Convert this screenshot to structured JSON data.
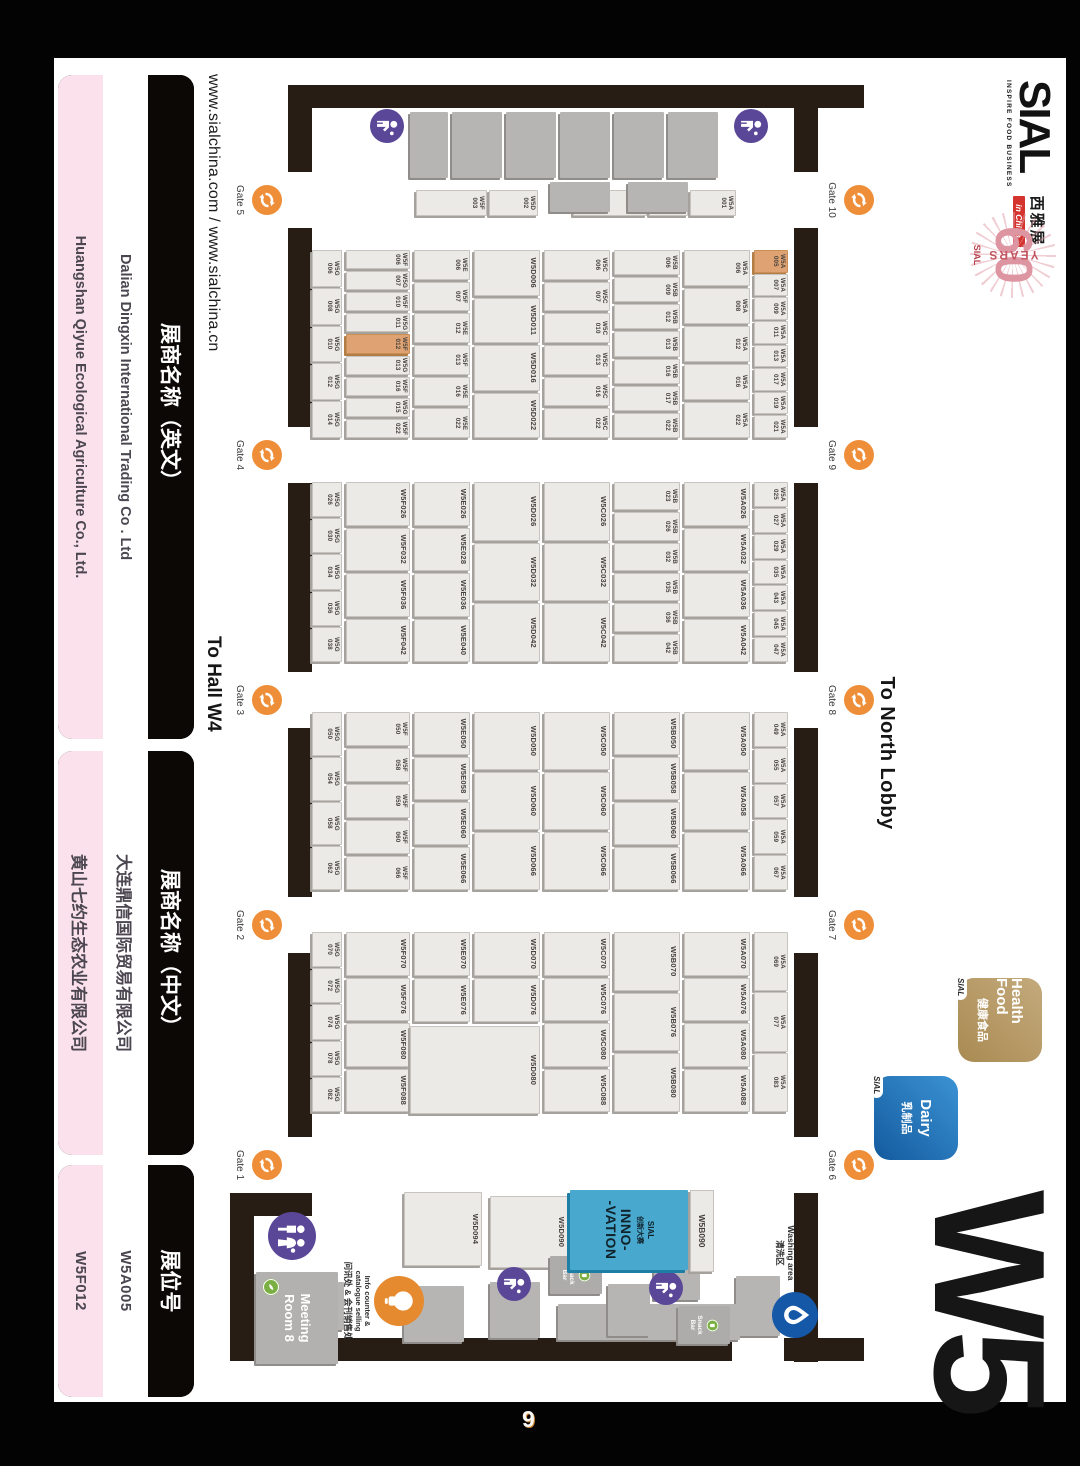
{
  "page": {
    "number": "9"
  },
  "header": {
    "url": "www.sialchina.com / www.sialchina.cn",
    "to_hall": "To Hall W4",
    "to_north_lobby": "To North Lobby",
    "hall_code": "W5"
  },
  "logo": {
    "name": "SIAL",
    "tagline": "INSPIRE FOOD BUSINESS",
    "cn": "西雅展",
    "in_china": "in China",
    "anniversary_60": "60",
    "anniversary_years": "YEARS",
    "anniversary_sial": "SIAL"
  },
  "badges": [
    {
      "id": "health-food",
      "line1": "Health Food",
      "cn": "健康食品",
      "brand": "SIAL",
      "color": "#b2945f"
    },
    {
      "id": "dairy",
      "line1": "Dairy",
      "cn": "乳制品",
      "brand": "SIAL",
      "color": "#1e6fb5"
    }
  ],
  "gates": {
    "top": [
      "Gate 10",
      "Gate 9",
      "Gate 8",
      "Gate 7",
      "Gate 6"
    ],
    "bottom": [
      "Gate 5",
      "Gate 4",
      "Gate 3",
      "Gate 2",
      "Gate 1"
    ]
  },
  "facilities": {
    "washing_line1": "Washing area",
    "washing_line2": "清洗区",
    "info_line1": "Info counter &",
    "info_line2": "catalogue selling",
    "info_line3": "问讯处 & 会刊销售处",
    "meeting_room": "Meeting Room 8",
    "snack_bar": "Snack Bar",
    "innovation": {
      "booth": "W5B090",
      "brand": "SIAL",
      "cn": "创新大赛",
      "line1": "INNO-",
      "line2": "-VATION"
    }
  },
  "legend": {
    "boxes": [
      {
        "title": "展商名称（英文）",
        "rows": [
          "Dalian Dingxin International Trading Co . Ltd",
          "Huangshan Qiyue Ecological Agriculture Co., Ltd."
        ]
      },
      {
        "title": "展商名称（中文）",
        "rows": [
          "大连鼎信国际贸易有限公司",
          "黄山七约生态农业有限公司"
        ]
      },
      {
        "title": "展位号",
        "rows": [
          "W5A005",
          "W5F012"
        ]
      }
    ]
  },
  "highlighted_booths": [
    "W5A005",
    "W5F012"
  ],
  "plan": {
    "left_column": [
      {
        "t": "W5A001",
        "wt": 1.2
      },
      {
        "t": "W5B001",
        "wt": 1.0
      },
      {
        "t": "W5C001",
        "wt": 2.0
      },
      {
        "sp": 0.8
      },
      {
        "t": "W5D002",
        "wt": 1.3
      },
      {
        "t": "W5F003",
        "wt": 1.9
      }
    ],
    "bands": [
      {
        "id": "a-strip",
        "segments": [
          [
            "W5A005",
            "W5A007",
            "W5A009",
            "W5A011",
            "W5A013",
            "W5A017",
            "W5A019",
            "W5A021"
          ],
          [
            "W5A025",
            "W5A027",
            "W5A029",
            "W5A035",
            "W5A043",
            "W5A045",
            "W5A047"
          ],
          [
            "W5A049",
            "W5A055",
            "W5A057",
            "W5A059",
            "W5A067"
          ],
          [
            "W5A069",
            "W5A077",
            "W5A083"
          ]
        ]
      },
      {
        "id": "row-a",
        "segments": [
          [
            "W5A006",
            "W5A008",
            "W5A012",
            "W5A016",
            "W5A022"
          ],
          [
            "W5A026",
            "W5A032",
            "W5A036",
            "W5A042"
          ],
          [
            "W5A050",
            "W5A058",
            "W5A066"
          ],
          [
            "W5A070",
            "W5A076",
            "W5A080",
            "W5A088"
          ]
        ]
      },
      {
        "id": "row-b",
        "segments": [
          [
            "W5B006",
            "W5B009",
            "W5B012",
            "W5B013",
            "W5B016",
            "W5B017",
            "W5B022"
          ],
          [
            "W5B023",
            "W5B026",
            "W5B032",
            "W5B035",
            "W5B036",
            "W5B042"
          ],
          [
            "W5B050",
            "W5B058",
            "W5B060",
            "W5B066"
          ],
          [
            "W5B070",
            "W5B076",
            "W5B080"
          ]
        ]
      },
      {
        "id": "row-c",
        "segments": [
          [
            "W5C006",
            "W5C007",
            "W5C010",
            "W5C013",
            "W5C016",
            "W5C022"
          ],
          [
            "W5C026",
            "W5C032",
            "W5C042"
          ],
          [
            "W5C050",
            "W5C060",
            "W5C066"
          ],
          [
            "W5C070",
            "W5C076",
            "W5C080",
            "W5C088"
          ]
        ]
      },
      {
        "id": "row-d",
        "segments": [
          [
            "W5D006",
            "W5D011",
            "W5D016",
            "W5D022"
          ],
          [
            "W5D026",
            "W5D032",
            "W5D042"
          ],
          [
            "W5D050",
            "W5D060",
            "W5D066"
          ],
          [
            "W5D070",
            "W5D076"
          ]
        ]
      },
      {
        "id": "row-e",
        "segments": [
          [
            "W5E006",
            "W5F007",
            "W5E012",
            "W5F013",
            "W5E016",
            "W5E022"
          ],
          [
            "W5E026",
            "W5E028",
            "W5E036",
            "W5E040"
          ],
          [
            "W5E050",
            "W5E058",
            "W5E060",
            "W5E066"
          ],
          [
            "W5E070",
            "W5E076"
          ]
        ]
      },
      {
        "id": "row-f",
        "segments": [
          [
            "W5F006",
            "W5G007",
            "W5F010",
            "W5G011",
            "W5F012",
            "W5G013",
            "W5F016",
            "W5G015",
            "W5F022"
          ],
          [
            "W5F026",
            "W5F032",
            "W5F036",
            "W5F042"
          ],
          [
            "W5F050",
            "W5F058",
            "W5F059",
            "W5F060",
            "W5F066"
          ],
          [
            "W5F070",
            "W5F076",
            "W5F080",
            "W5F088"
          ]
        ]
      },
      {
        "id": "g-strip",
        "segments": [
          [
            "W5G006",
            "W5G008",
            "W5G010",
            "W5G012",
            "W5G014"
          ],
          [
            "W5G026",
            "W5G030",
            "W5G034",
            "W5G036",
            "W5G038"
          ],
          [
            "W5G050",
            "W5G054",
            "W5G058",
            "W5G062"
          ],
          [
            "W5G070",
            "W5G072",
            "W5G074",
            "W5G078",
            "W5G082"
          ]
        ]
      }
    ],
    "specials": [
      "W5D080",
      "W5D090",
      "W5D094"
    ]
  }
}
